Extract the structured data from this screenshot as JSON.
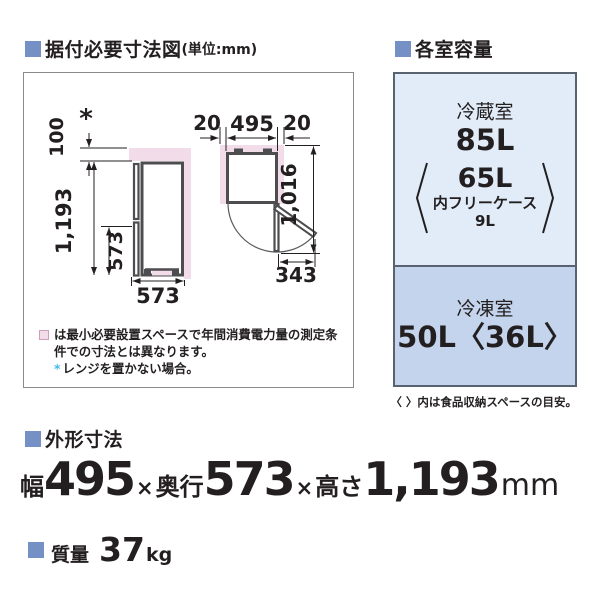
{
  "header_left": {
    "title": "据付必要寸法図",
    "unit": "(単位:mm)"
  },
  "header_right": {
    "title": "各室容量"
  },
  "diagram": {
    "side_view": {
      "asterisk": "*",
      "top_clearance": "100",
      "height": "1,193",
      "lower_height": "573",
      "depth": "573"
    },
    "top_view": {
      "left_clearance": "20",
      "width": "495",
      "right_clearance": "20",
      "open_depth": "1,016",
      "door_swing": "343"
    },
    "note1": "は最小必要設置スペースで年間消費電力量の測定条件での寸法とは異なります。",
    "note2_marker": "*",
    "note2": "レンジを置かない場合。"
  },
  "capacity": {
    "fridge_label": "冷蔵室",
    "fridge_total": "85L",
    "fridge_inner": "65L",
    "fridge_case_label": "内フリーケース",
    "fridge_case_value": "9L",
    "freezer_label": "冷凍室",
    "freezer_value": "50L〈36L〉",
    "caption": "〈 〉内は食品収納スペースの目安。"
  },
  "outer_dimensions": {
    "title": "外形寸法",
    "width_label": "幅",
    "width": "495",
    "times1": "×",
    "depth_label": "奥行",
    "depth": "573",
    "times2": "×",
    "height_label": "高さ",
    "height": "1,193",
    "unit": "mm"
  },
  "weight": {
    "title": "質量",
    "value": "37",
    "unit": "kg"
  },
  "colors": {
    "accent_square": "#7590c4",
    "dimension_blue": "#1d5dad",
    "asterisk_cyan": "#45b8e8",
    "minimum_space_pink": "#f2dce9",
    "fridge_section_bg": "#e1ecf8",
    "freezer_section_bg": "#c3d4ec",
    "panel_border": "#596270"
  }
}
